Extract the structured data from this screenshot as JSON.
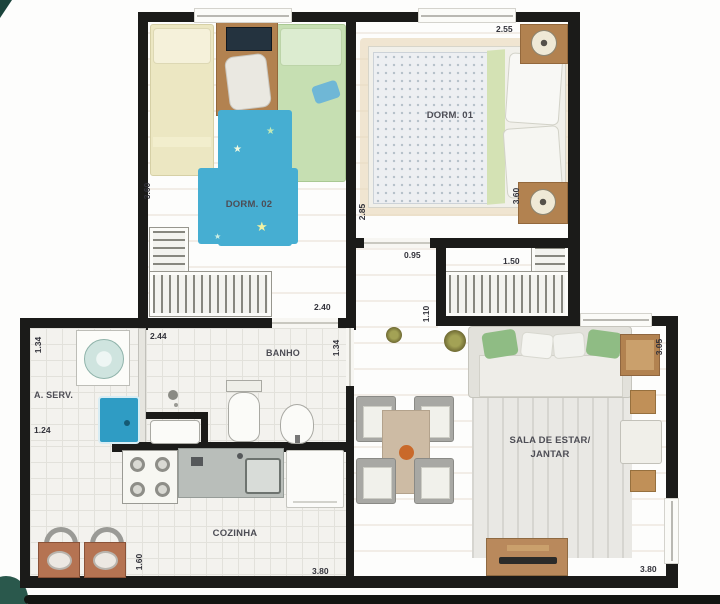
{
  "rooms": {
    "dorm02": "DORM. 02",
    "dorm01": "DORM. 01",
    "banho": "BANHO",
    "aserv": "A. SERV.",
    "cozinha": "COZINHA",
    "sala_line1": "SALA DE ESTAR/",
    "sala_line2": "JANTAR"
  },
  "dimensions": {
    "dorm01_top": "2.55",
    "dorm02_left": "3.60",
    "dorm01_right": "3.60",
    "hall_upper": "2.85",
    "dorm01_door": "0.95",
    "closet": "1.50",
    "dorm02_bottom": "2.40",
    "hall_lower": "1.10",
    "banho_top": "2.44",
    "aserv_left": "1.34",
    "banho_right": "1.34",
    "aserv_bottom": "1.24",
    "sala_right": "3.05",
    "cozinha_left": "1.60",
    "cozinha_bottom": "3.80",
    "sala_bottom": "3.80"
  },
  "icons": {
    "star": "★"
  },
  "colors": {
    "wall": "#1b1b19",
    "wood": "#d5ad79",
    "tile": "#f3f2ee",
    "rug_blue": "#46aed2",
    "pillow_green": "#8fbc84",
    "tank_blue": "#2f9cc4",
    "furniture_brown": "#b28250",
    "accent_dark_green": "#224c43"
  }
}
